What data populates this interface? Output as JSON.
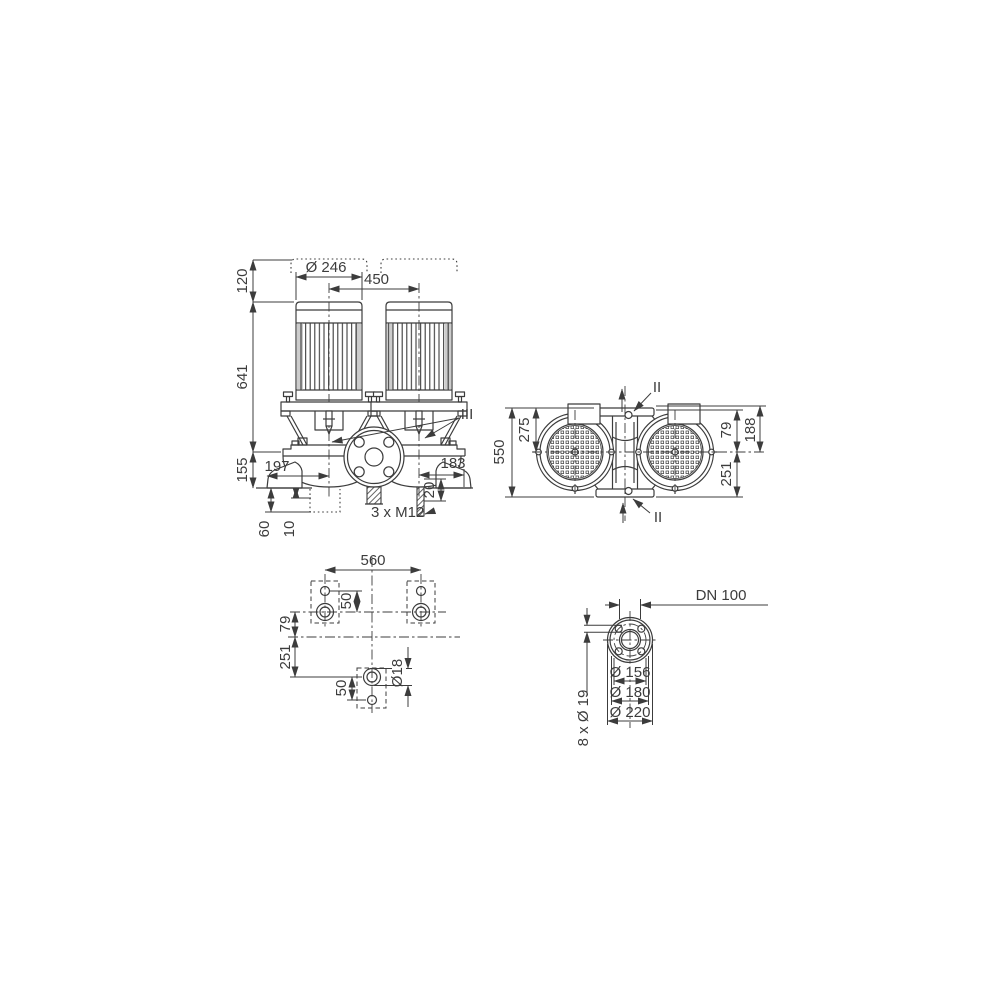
{
  "colors": {
    "line": "#3c3c3c",
    "background": "#ffffff"
  },
  "front_view": {
    "dim_removal_clearance": "120",
    "dim_motor_diameter": "Ø 246",
    "dim_pump_spacing": "450",
    "dim_height_to_axis": "641",
    "dim_axis_to_base": "155",
    "dim_left_offset": "197",
    "dim_right_offset": "183",
    "dim_stud_projection": "20",
    "label_studs": "3 x M12",
    "dim_foundation_depth": "60",
    "dim_grout_thickness": "10",
    "label_vent": "III"
  },
  "top_view": {
    "dim_overall_length": "550",
    "dim_axis_to_end": "275",
    "label_flange_top": "II",
    "label_flange_bottom": "II",
    "dim_79": "79",
    "dim_188": "188",
    "dim_251": "251"
  },
  "foundation_view": {
    "dim_bolt_span": "560",
    "dim_hole_pitch_upper": "50",
    "dim_79": "79",
    "dim_251": "251",
    "dim_hole_pitch_lower": "50",
    "dim_hole_diameter": "Ø18"
  },
  "flange_view": {
    "label_nominal": "DN 100",
    "dim_recess": "Ø 156",
    "dim_bolt_circle": "Ø 180",
    "dim_outer": "Ø 220",
    "label_bolt_holes": "8 x Ø 19"
  }
}
